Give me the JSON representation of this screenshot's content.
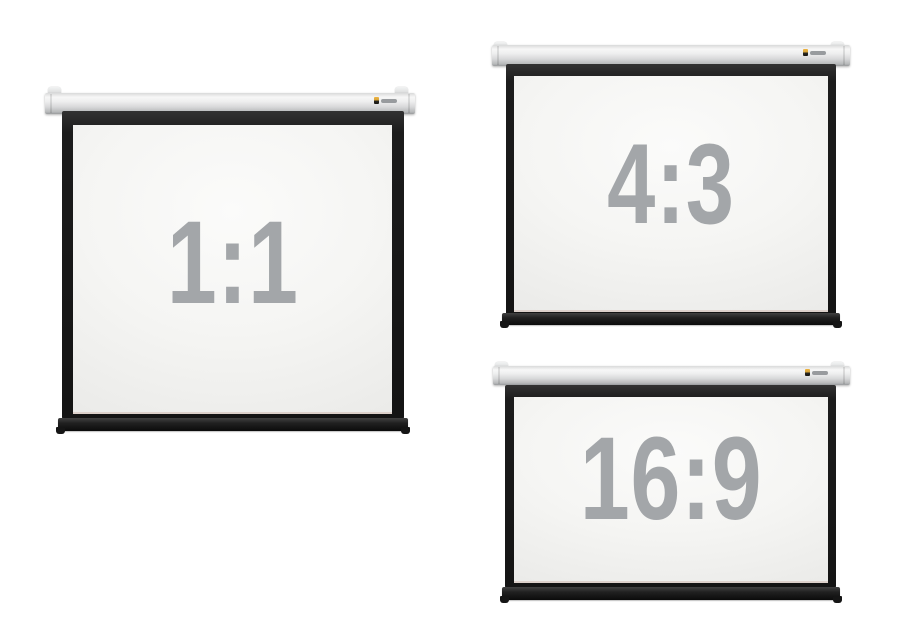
{
  "scene": {
    "name": "projection-screens-aspect-ratio-comparison",
    "background_color": "#ffffff"
  },
  "colors": {
    "casing_gray_light": "#f7f7f7",
    "casing_gray_dark": "#989a9c",
    "frame_black": "#141414",
    "surface_white": "#f5f5f3",
    "label_gray": "#a3a6a9",
    "logo_accent_yellow": "#efb441"
  },
  "screens": [
    {
      "name": "screen-1-1",
      "ratio_label": "1:1"
    },
    {
      "name": "screen-4-3",
      "ratio_label": "4:3"
    },
    {
      "name": "screen-16-9",
      "ratio_label": "16:9"
    }
  ],
  "icons": {
    "brand_logo": "brand-logo-icon",
    "mounting_bracket": "mounting-bracket-icon"
  }
}
